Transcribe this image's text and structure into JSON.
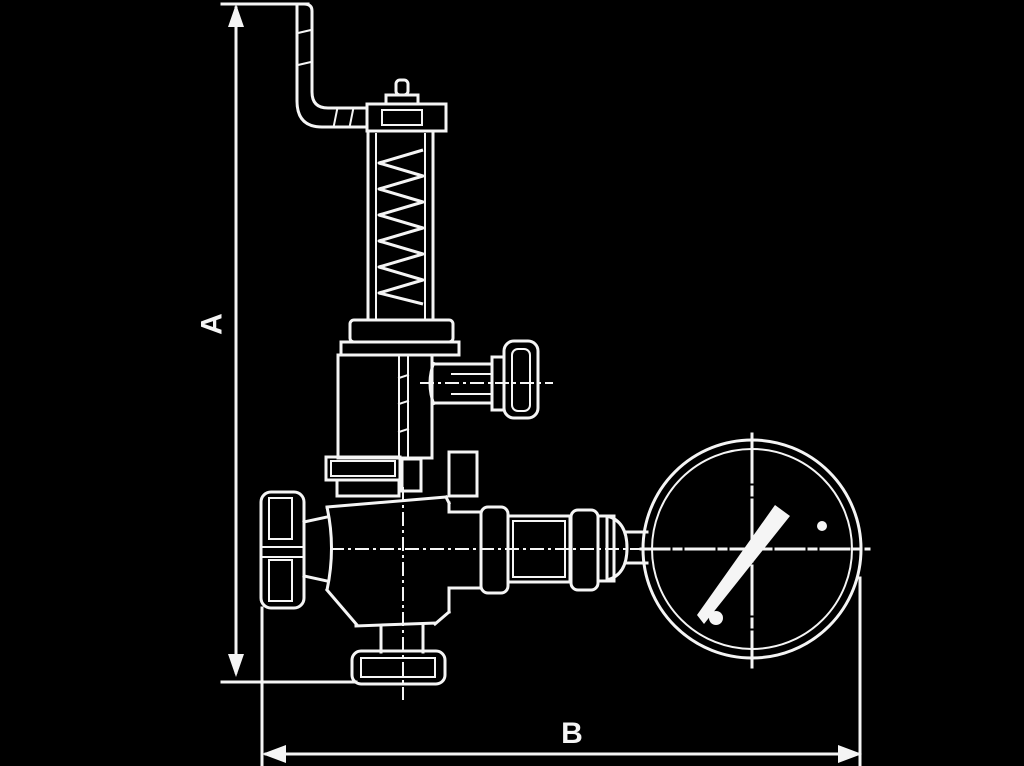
{
  "page": {
    "background_color": "#000000",
    "line_color": "#f5f5f5",
    "description": "black-background engineering line drawing"
  },
  "figure": {
    "type": "technical-cross-section-drawing",
    "subject": "spring-loaded safety relief valve with bent lever pipe, spring bonnet, side test cap, inlet handwheel, outlet union fitting and pressure gauge",
    "components": [
      "bent-lever-pipe",
      "adjusting-screw-cap",
      "spring-housing-with-coil-spring",
      "bonnet",
      "side-test-port-with-cap",
      "packing-flange",
      "inlet-handwheel",
      "valve-body",
      "bottom-drain-cap",
      "outlet-union-fitting",
      "reducer-cone",
      "pressure-gauge-dial",
      "gauge-needle"
    ]
  },
  "dimensions": {
    "a": {
      "label": "A",
      "orientation": "vertical",
      "measures": "overall height from top of lever pipe to valve base"
    },
    "b": {
      "label": "B",
      "orientation": "horizontal",
      "measures": "overall width from handwheel face to gauge edge"
    }
  }
}
